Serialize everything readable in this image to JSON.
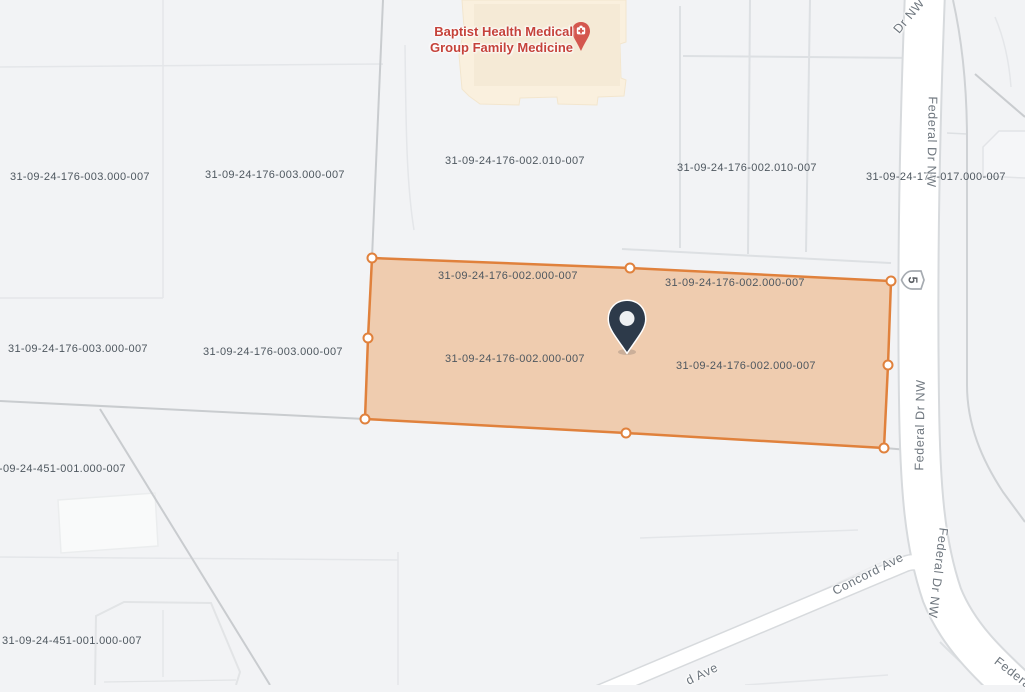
{
  "map": {
    "poi": {
      "name_line1": "Baptist Health Medical",
      "name_line2": "Group Family Medicine"
    },
    "roads": {
      "federal_full": "Federal Dr NW",
      "federal_top": "Dr NW",
      "federal_partial": "Federa",
      "concord": "Concord Ave",
      "concord_partial": "d Ave",
      "route_shield": "5"
    },
    "parcel_labels": [
      "31-09-24-176-003.000-007",
      "31-09-24-176-003.000-007",
      "31-09-24-176-002.010-007",
      "31-09-24-176-002.010-007",
      "31-09-24-176-017.000-007",
      "31-09-24-176-002.000-007",
      "31-09-24-176-002.000-007",
      "31-09-24-176-002.000-007",
      "31-09-24-176-002.000-007",
      "31-09-24-176-003.000-007",
      "31-09-24-176-003.000-007",
      "31-09-24-451-001.000-007",
      "31-09-24-451-001.000-007"
    ]
  },
  "colors": {
    "selected_parcel_stroke": "#E0813C",
    "selected_parcel_fill": "rgba(236,146,70,0.40)",
    "poi_text": "#C5423A",
    "pin": "#2D3A4A",
    "road_fill": "#FFFFFF",
    "road_casing": "#D7DADD"
  }
}
